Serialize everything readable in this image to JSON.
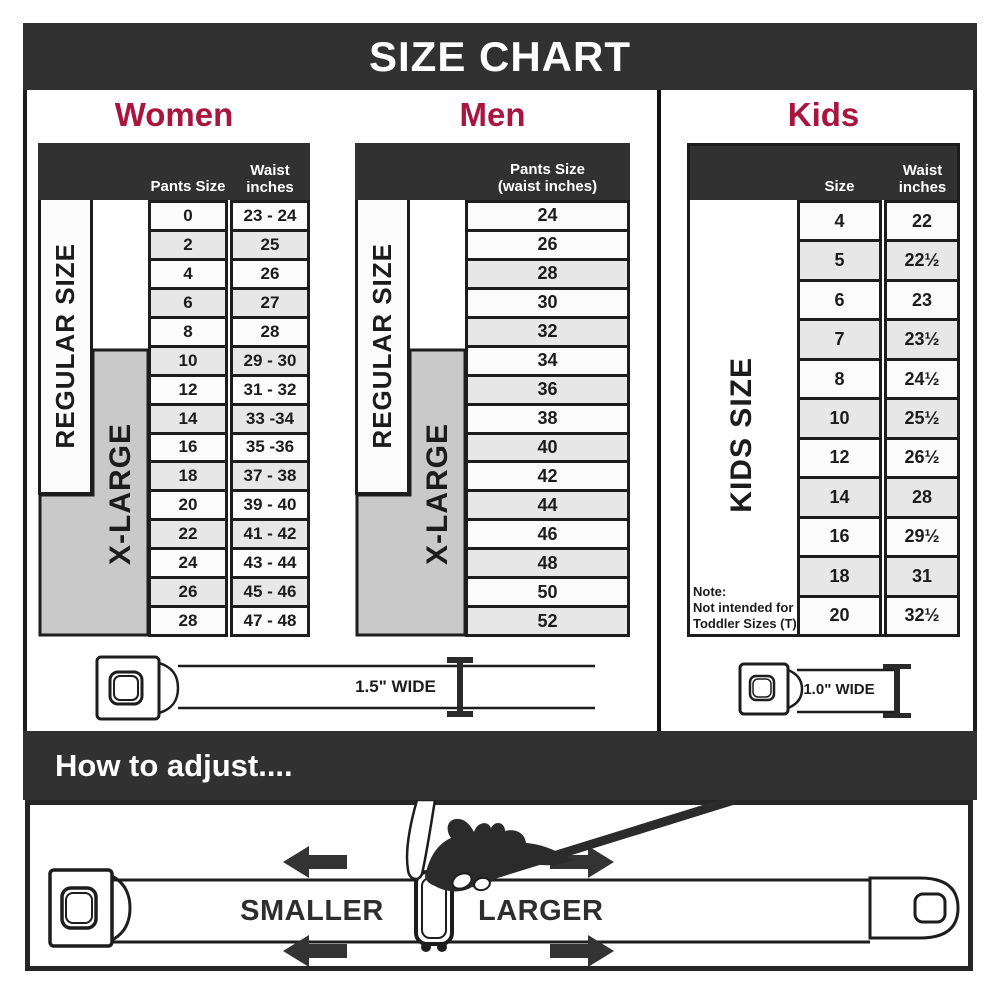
{
  "title": "SIZE CHART",
  "colors": {
    "bar": "#313131",
    "accent": "#a81640",
    "gray_block": "#c9c9c9",
    "row_alt": "#e7e7e7",
    "row_light": "#fbfbfb",
    "border": "#1d1d1d"
  },
  "women": {
    "heading": "Women",
    "col1_header": "Pants Size",
    "col2_header_line1": "Waist",
    "col2_header_line2": "inches",
    "regular_label": "REGULAR SIZE",
    "xlarge_label": "X-LARGE",
    "rows": [
      {
        "size": "0",
        "waist": "23 - 24"
      },
      {
        "size": "2",
        "waist": "25"
      },
      {
        "size": "4",
        "waist": "26"
      },
      {
        "size": "6",
        "waist": "27"
      },
      {
        "size": "8",
        "waist": "28"
      },
      {
        "size": "10",
        "waist": "29 - 30"
      },
      {
        "size": "12",
        "waist": "31 - 32"
      },
      {
        "size": "14",
        "waist": "33 -34"
      },
      {
        "size": "16",
        "waist": "35 -36"
      },
      {
        "size": "18",
        "waist": "37 - 38"
      },
      {
        "size": "20",
        "waist": "39 - 40"
      },
      {
        "size": "22",
        "waist": "41 - 42"
      },
      {
        "size": "24",
        "waist": "43 - 44"
      },
      {
        "size": "26",
        "waist": "45 - 46"
      },
      {
        "size": "28",
        "waist": "47 - 48"
      }
    ]
  },
  "men": {
    "heading": "Men",
    "col_header_line1": "Pants Size",
    "col_header_line2": "(waist inches)",
    "regular_label": "REGULAR SIZE",
    "xlarge_label": "X-LARGE",
    "rows": [
      "24",
      "26",
      "28",
      "30",
      "32",
      "34",
      "36",
      "38",
      "40",
      "42",
      "44",
      "46",
      "48",
      "50",
      "52"
    ]
  },
  "kids": {
    "heading": "Kids",
    "col1_header": "Size",
    "col2_header_line1": "Waist",
    "col2_header_line2": "inches",
    "side_label": "KIDS SIZE",
    "note_line1": "Note:",
    "note_line2": "Not intended for",
    "note_line3": "Toddler Sizes (T)",
    "rows": [
      {
        "size": "4",
        "waist": "22"
      },
      {
        "size": "5",
        "waist": "22½"
      },
      {
        "size": "6",
        "waist": "23"
      },
      {
        "size": "7",
        "waist": "23½"
      },
      {
        "size": "8",
        "waist": "24½"
      },
      {
        "size": "10",
        "waist": "25½"
      },
      {
        "size": "12",
        "waist": "26½"
      },
      {
        "size": "14",
        "waist": "28"
      },
      {
        "size": "16",
        "waist": "29½"
      },
      {
        "size": "18",
        "waist": "31"
      },
      {
        "size": "20",
        "waist": "32½"
      }
    ]
  },
  "belts": {
    "adult_width_label": "1.5\" WIDE",
    "kids_width_label": "1.0\" WIDE"
  },
  "adjust": {
    "heading": "How to adjust....",
    "smaller_label": "SMALLER",
    "larger_label": "LARGER"
  }
}
